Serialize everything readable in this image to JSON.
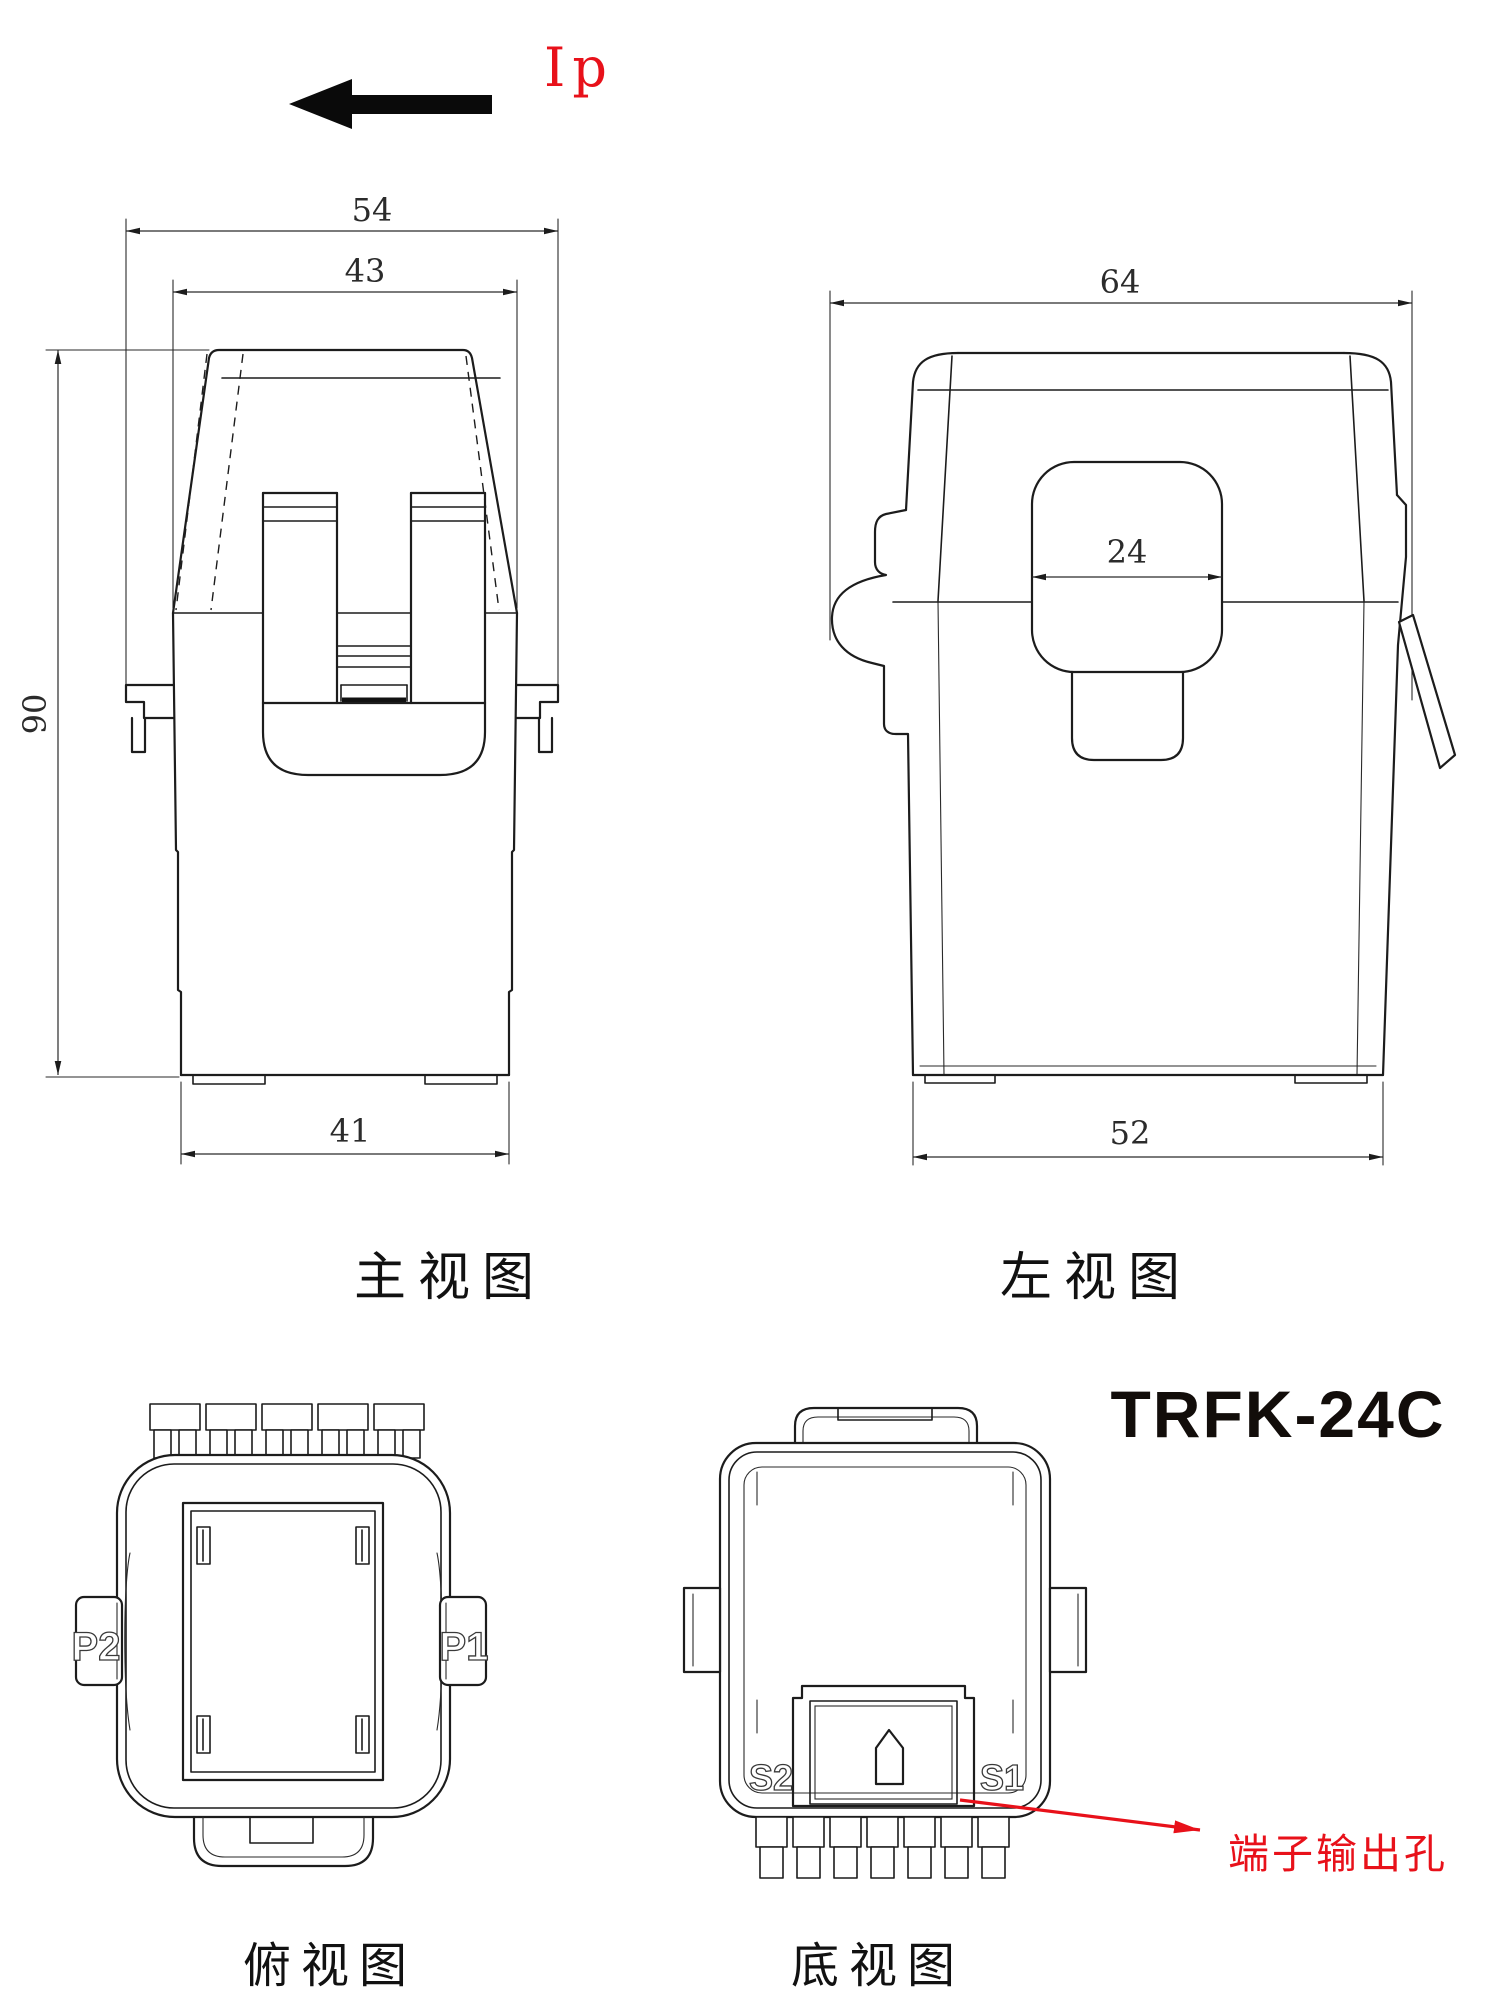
{
  "title": "TRFK-24C",
  "current_label": "Ip",
  "colors": {
    "annotation_red": "#e8111a",
    "line": "#1c1c1c"
  },
  "views": {
    "front": {
      "label": "主视图",
      "dims": {
        "outer_width": "54",
        "body_width": "43",
        "height": "90",
        "bottom_width": "41"
      }
    },
    "left": {
      "label": "左视图",
      "dims": {
        "total_width": "64",
        "aperture_width": "24",
        "bottom_width": "52"
      }
    },
    "top": {
      "label": "俯视图",
      "terminals": {
        "left": "P2",
        "right": "P1"
      }
    },
    "bottom": {
      "label": "底视图",
      "terminals": {
        "left": "S2",
        "right": "S1"
      },
      "annotation": "端子输出孔"
    }
  }
}
